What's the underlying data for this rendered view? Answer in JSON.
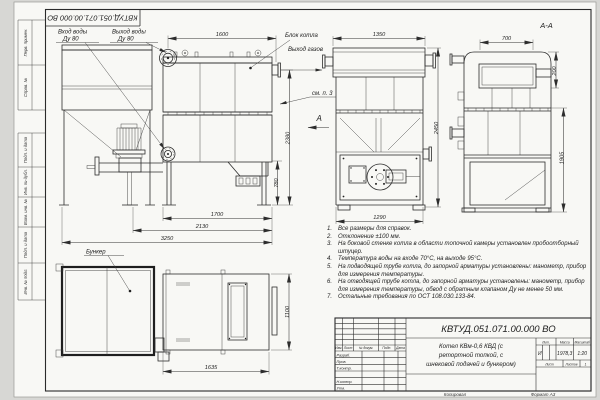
{
  "stamp_top": {
    "designation": "КВТУД.051.071.00.000 ВО"
  },
  "margin": {
    "labels": [
      "Перв. примен.",
      "Справ. №",
      "Подп. и дата",
      "Инв. № дубл.",
      "Взам. инв. №",
      "Подп. и дата",
      "Инв. № подл."
    ]
  },
  "drawing": {
    "section_title": "А-А",
    "view_arrow": "А",
    "labels": {
      "water_in_line1": "Вход воды",
      "water_in_line2": "Ду 80",
      "water_out_line1": "Выход воды",
      "water_out_line2": "Ду 80",
      "boiler_block": "Блок котла",
      "gas_out": "Выход газов",
      "see_note3": "см. п. 3",
      "bunker": "Бункер"
    },
    "dims": {
      "boiler_len": "1600",
      "height_total": "2380",
      "ash_height": "780",
      "block_len": "1700",
      "mid_len": "2130",
      "total_len": "3250",
      "front_width": "1350",
      "front_height": "2450",
      "furnace_width": "1290",
      "section_width": "700",
      "gas_offset": "200",
      "section_height": "1905",
      "plan_len": "1635",
      "plan_width": "1100"
    }
  },
  "notes": {
    "items": [
      {
        "num": "1.",
        "text": "Все размеры для справок."
      },
      {
        "num": "2.",
        "text": "Отклонение ±100 мм."
      },
      {
        "num": "3.",
        "text": "На боковой стенке котла в области топочной камеры установлен пробоотборный штуцер."
      },
      {
        "num": "4.",
        "text": "Температура воды на входе 70°С, на выходе 95°С."
      },
      {
        "num": "5.",
        "text": "На подводящей трубе котла, до запорной арматуры установлены: манометр, прибор для измерения температуры."
      },
      {
        "num": "6.",
        "text": "На отводящей трубе котла, до запорной арматуры установлены: манометр, прибор для измерения температуры, обвод с обратным клапаном Ду не менее 50 мм."
      },
      {
        "num": "7.",
        "text": "Остальные требования по ОСТ 108.030.133-84."
      }
    ]
  },
  "title_block": {
    "designation": "КВТУД.051.071.00.000 ВО",
    "name_line1": "Котел КВм-0,6 КВД (с",
    "name_line2": "ретортной топкой, с",
    "name_line3": "шнековой подачей и бункером)",
    "header": {
      "izm": "Изм.",
      "list": "Лист",
      "doc": "№ докум.",
      "podp": "Подп.",
      "data": "Дата"
    },
    "rows": {
      "razrab": "Разраб.",
      "prov": "Пров.",
      "tkontr": "Т.контр.",
      "nkontr": "Н.контр.",
      "utv": "Утв."
    },
    "lit_label": "Лит.",
    "mass_label": "Масса",
    "scale_label": "Масштаб",
    "lit_value": "И",
    "mass_value": "1978,3",
    "scale_value": "1:20",
    "sheet_label": "Лист",
    "sheets_label": "Листов",
    "sheets_value": "1",
    "copied": "Копировал",
    "format": "Формат А3"
  }
}
